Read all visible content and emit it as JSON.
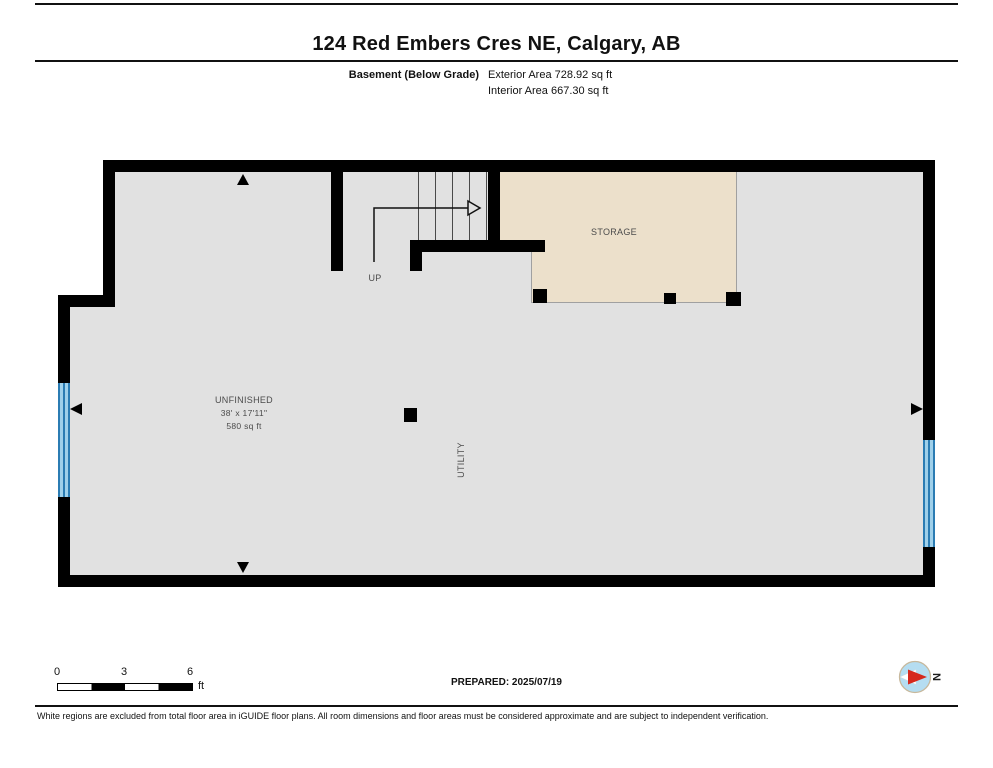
{
  "header": {
    "title": "124 Red Embers Cres NE, Calgary, AB",
    "floor_label": "Basement (Below Grade)",
    "exterior_area": "Exterior Area 728.92 sq ft",
    "interior_area": "Interior Area 667.30 sq ft"
  },
  "plan": {
    "rooms": [
      {
        "label": "STORAGE"
      },
      {
        "label": "UNFINISHED",
        "dimensions": "38' x 17'11\"",
        "area": "580 sq ft"
      },
      {
        "label": "UTILITY"
      }
    ],
    "stairs": {
      "direction_label": "UP"
    },
    "colors": {
      "wall": "#000000",
      "floor": "#e1e1e1",
      "storage_fill": "#ece0cb",
      "window_fill": "#9fd0ea",
      "window_line": "#2b7cb3",
      "compass_needle_red": "#d6281c"
    }
  },
  "footer": {
    "scale": {
      "ticks": [
        "0",
        "3",
        "6"
      ],
      "unit": "ft"
    },
    "prepared": "PREPARED: 2025/07/19",
    "compass_label": "N",
    "disclaimer": "White regions are excluded from total floor area in iGUIDE floor plans. All room dimensions and floor areas must be considered approximate and are subject to independent verification."
  }
}
